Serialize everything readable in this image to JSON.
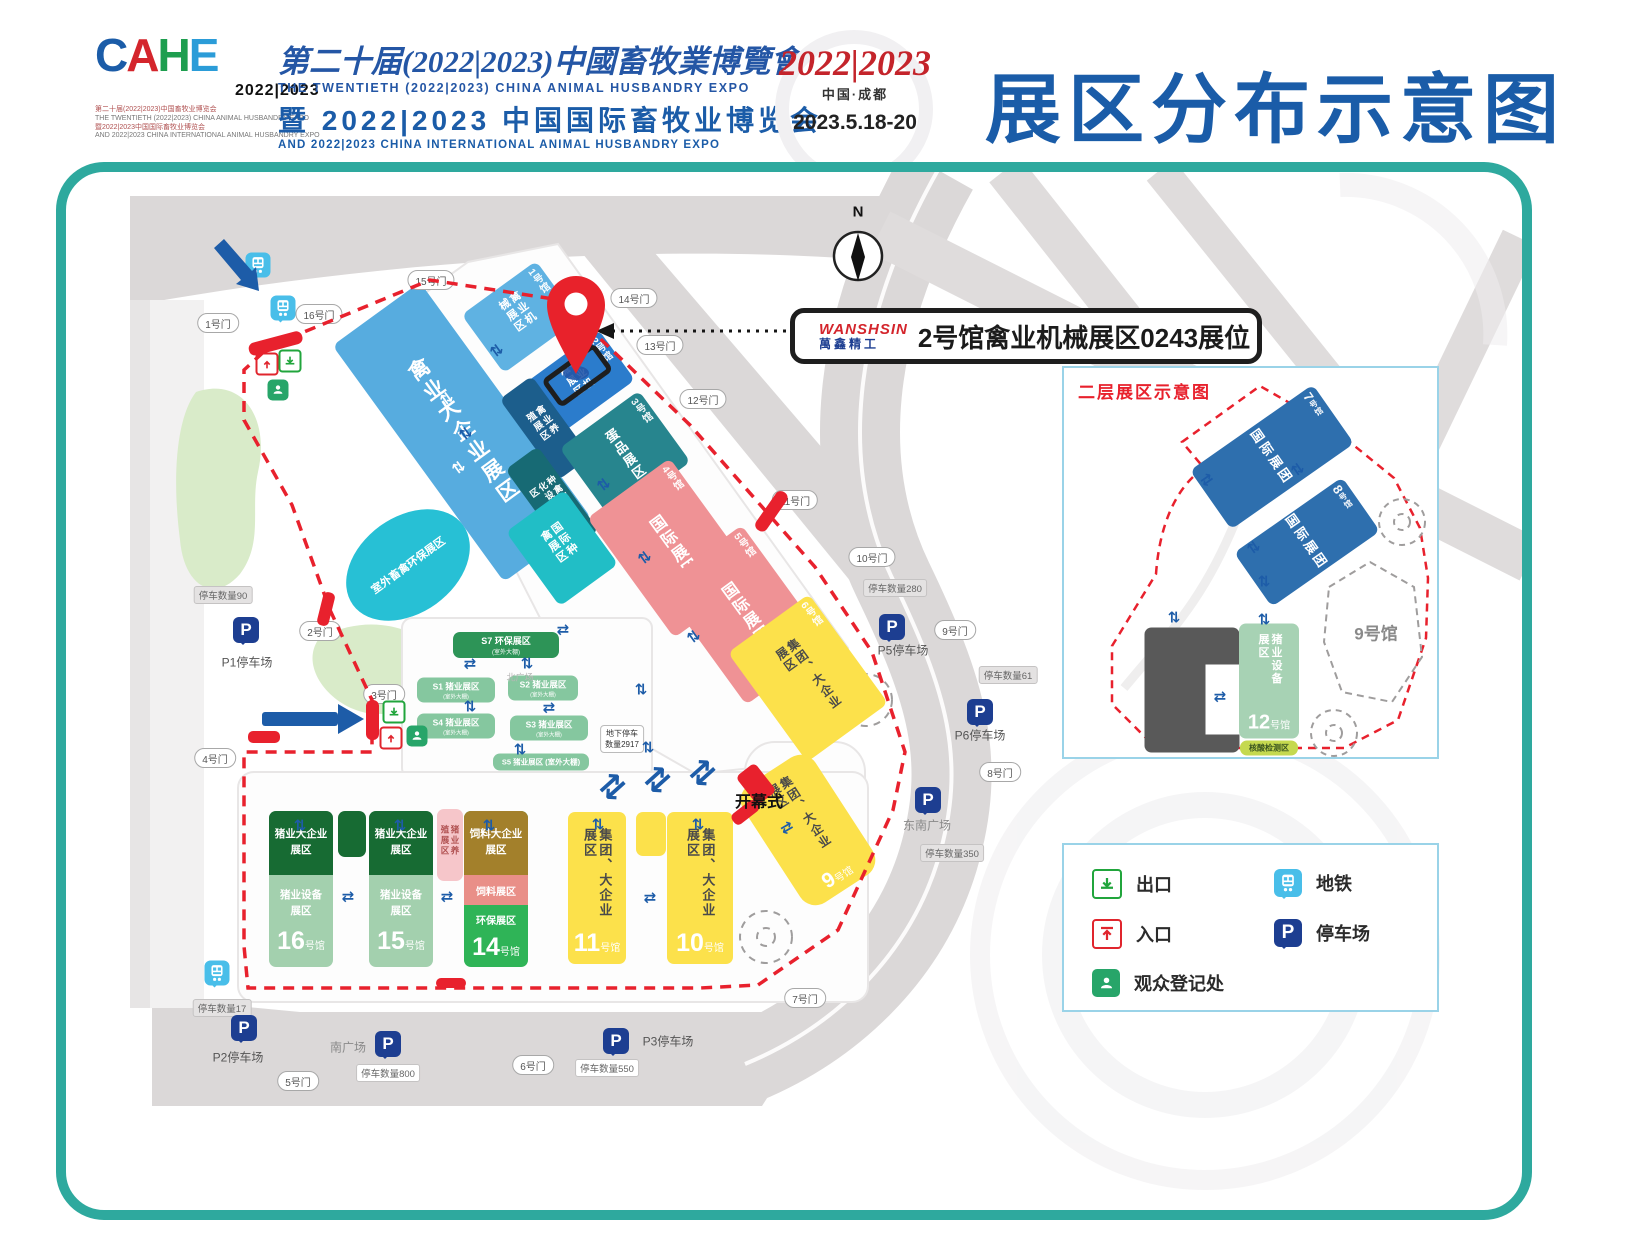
{
  "header": {
    "logo": {
      "letters": [
        "C",
        "A",
        "H",
        "E"
      ],
      "years": "2022|2023",
      "tiny": [
        "第二十届(2022|2023)中国畜牧业博览会",
        "THE TWENTIETH (2022|2023) CHINA ANIMAL HUSBANDRY EXPO",
        "暨2022|2023中国国际畜牧业博览会",
        "AND 2022|2023 CHINA INTERNATIONAL ANIMAL HUSBANDRY EXPO"
      ]
    },
    "title_cn": "第二十届(2022|2023)中國畜牧業博覽會",
    "title_en": "THE TWENTIETH (2022|2023) CHINA ANIMAL HUSBANDRY EXPO",
    "subtitle_cn": "暨 2022|2023 中国国际畜牧业博览会",
    "subtitle_en": "AND 2022|2023 CHINA INTERNATIONAL ANIMAL HUSBANDRY EXPO",
    "event_years": "2022|2023",
    "event_city": "中国·成都",
    "event_dates": "2023.5.18-20",
    "page_title": "展区分布示意图"
  },
  "callout": {
    "brand_en": "WANSHSIN",
    "brand_cn": "萬鑫精工",
    "booth": "2号馆禽业机械展区0243展位"
  },
  "compass": {
    "label": "N"
  },
  "halls": {
    "big": "禽业大企业展区",
    "h1": {
      "num": "1号馆",
      "name": "禽业机械展区"
    },
    "h2": {
      "num": "2号馆",
      "name": "禽业机械展区"
    },
    "breeding": "禽业养殖展区",
    "hatchery": "种禽孵化设备区",
    "h3": {
      "num": "3号馆",
      "name": "蛋品展区"
    },
    "intl_poultry": "国际种禽展区",
    "h4": {
      "num": "4号馆",
      "name": "国际展团"
    },
    "h5": {
      "num": "5号馆",
      "name": "国际展团"
    },
    "h6": {
      "num": "6号馆",
      "name": "集团、大企业展区"
    },
    "h9": {
      "num": "9",
      "suffix": "号馆",
      "name": "集团、大企业展区"
    },
    "h10": {
      "num": "10",
      "suffix": "号馆",
      "name": "集团、大企业展区"
    },
    "h11": {
      "num": "11",
      "suffix": "号馆",
      "name": "集团、大企业展区"
    },
    "h14": {
      "num": "14",
      "suffix": "号馆",
      "feed_big": "饲料大企业展区",
      "feed": "饲料展区",
      "eco": "环保展区"
    },
    "h15": {
      "num": "15",
      "suffix": "号馆"
    },
    "h16": {
      "num": "16",
      "suffix": "号馆"
    },
    "pig_big": "猪业大企业展区",
    "pig_equip": "猪业设备展区",
    "pig_breeding": "猪业养殖展区"
  },
  "szones": {
    "s1": "S1 猪业展区",
    "s2": "S2 猪业展区",
    "s3": "S3 猪业展区",
    "s4": "S4 猪业展区",
    "s5": "S5 猪业展区 (室外大棚)",
    "s7": "S7 环保展区",
    "outdoor": "(室外大棚)"
  },
  "gates": {
    "g1": "1号门",
    "g2": "2号门",
    "g3": "3号门",
    "g4": "4号门",
    "g5": "5号门",
    "g6": "6号门",
    "g7": "7号门",
    "g8": "8号门",
    "g9": "9号门",
    "g10": "10号门",
    "g11": "11号门",
    "g12": "12号门",
    "g13": "13号门",
    "g14": "14号门",
    "g15": "15号门",
    "g16": "16号门"
  },
  "parking": {
    "icon": "P",
    "p1": {
      "name": "P1停车场",
      "count": "停车数量90"
    },
    "p2": {
      "name": "P2停车场",
      "count": "停车数量17"
    },
    "p3": {
      "name": "P3停车场",
      "count": "停车数量550"
    },
    "p5": {
      "name": "P5停车场",
      "count": "停车数量280"
    },
    "p6": {
      "name": "P6停车场",
      "count": "停车数量61"
    },
    "south": {
      "name": "南广场",
      "count": "停车数量800"
    },
    "southeast": {
      "name": "东南广场",
      "count": "停车数量350"
    }
  },
  "notes": {
    "opening": "开幕式",
    "underground_1": "地下停车",
    "underground_2": "数量2917",
    "outdoor_eco": "室外畜禽环保展区",
    "north_plaza": "北广场"
  },
  "inset": {
    "title": "二层展区示意图",
    "h7": {
      "num": "7",
      "suffix": "号馆",
      "name": "国际展团"
    },
    "h8": {
      "num": "8",
      "suffix": "号馆",
      "name": "国际展团"
    },
    "h9": "9号馆",
    "h12": {
      "num": "12",
      "suffix": "号馆",
      "name": "猪业设备展区",
      "nucleic": "核酸检测区"
    }
  },
  "legend": {
    "exit": "出口",
    "entrance": "入口",
    "registration": "观众登记处",
    "subway": "地铁",
    "parking": "停车场"
  },
  "icons": {
    "esc_v": "⇅",
    "esc_h": "⇄"
  }
}
